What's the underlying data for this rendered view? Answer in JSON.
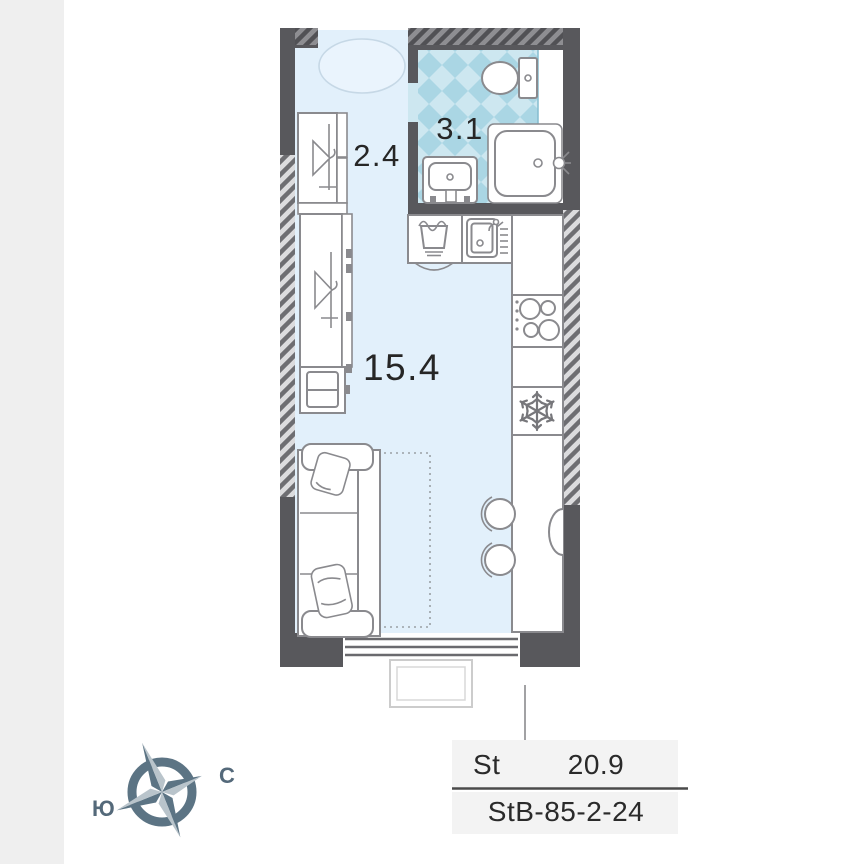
{
  "rooms": [
    {
      "name": "hall",
      "area": "2.4"
    },
    {
      "name": "bathroom",
      "area": "3.1"
    },
    {
      "name": "living-room",
      "area": "15.4"
    }
  ],
  "summary": {
    "type_label": "St",
    "total_area": "20.9",
    "unit_code": "StB-85-2-24"
  },
  "compass": {
    "north": "С",
    "south": "Ю"
  },
  "colors": {
    "floor": "#e2f0fb",
    "tile_base": "#cde7f0",
    "tile_diamond": "#aad6e4",
    "wall_solid": "#58585c",
    "hatch_light_bg": "#dcdcde",
    "hatch_light_stroke": "#6e6e72",
    "hatch_dark_bg": "#8e8e92",
    "hatch_dark_stroke": "#515155",
    "furniture_stroke": "#8a8a8e",
    "summary_row_bg": "#f3f3f3",
    "compass_dark": "#5c7484",
    "compass_light": "#b9c4cb",
    "gallery_edge_bg": "#efefef"
  },
  "icons": [
    "rug",
    "hanger",
    "toilet",
    "shower",
    "washbasin",
    "laundry-basket",
    "kitchen-sink",
    "cooktop",
    "snowflake",
    "sofa",
    "pillow",
    "bed-dotted-outline",
    "stool",
    "table",
    "window",
    "balcony",
    "compass-rose"
  ]
}
